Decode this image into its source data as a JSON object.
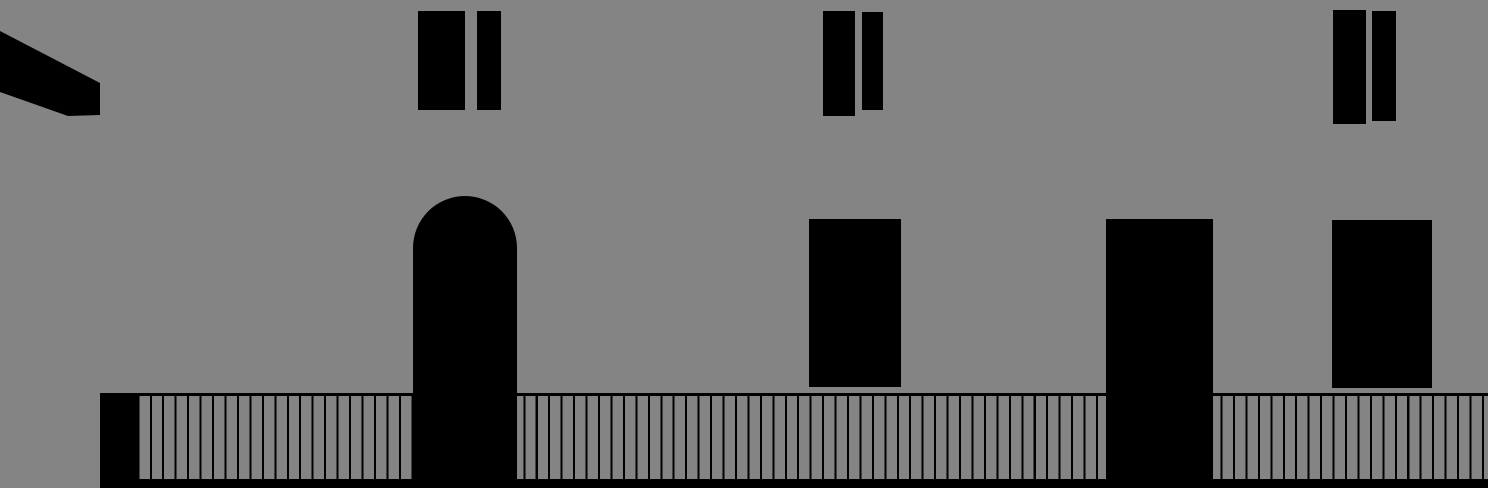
{
  "scene": {
    "colors": {
      "background": "#848484",
      "ink": "#000000",
      "slat": "#848484"
    },
    "stage": {
      "width": 1488,
      "height": 488
    },
    "elements": [
      {
        "type": "fence",
        "name": "boardwalk-fence",
        "x": 100,
        "y": 393,
        "w": 1388,
        "h": 86,
        "top_line": 3,
        "slat_line": 2,
        "slat_period": 12.45
      },
      {
        "type": "rect",
        "name": "ground-strip",
        "x": 100,
        "y": 479,
        "w": 1388,
        "h": 9
      },
      {
        "type": "rect",
        "name": "fence-end-post",
        "x": 100,
        "y": 393,
        "w": 39,
        "h": 95
      },
      {
        "type": "beam",
        "name": "roof-beam",
        "x": 0,
        "y": 0,
        "w": 102,
        "h": 120,
        "points": [
          [
            0,
            31
          ],
          [
            100,
            83
          ],
          [
            100,
            115
          ],
          [
            68,
            116
          ],
          [
            0,
            92
          ]
        ]
      },
      {
        "type": "rect",
        "name": "window-1-left",
        "x": 418,
        "y": 11,
        "w": 47,
        "h": 99
      },
      {
        "type": "rect",
        "name": "window-1-right",
        "x": 477,
        "y": 11,
        "w": 24,
        "h": 99
      },
      {
        "type": "rect",
        "name": "window-2-left",
        "x": 823,
        "y": 11,
        "w": 32,
        "h": 105
      },
      {
        "type": "rect",
        "name": "window-2-right",
        "x": 862,
        "y": 12,
        "w": 21,
        "h": 98
      },
      {
        "type": "rect",
        "name": "window-3-left",
        "x": 1333,
        "y": 10,
        "w": 33,
        "h": 114
      },
      {
        "type": "rect",
        "name": "window-3-right",
        "x": 1372,
        "y": 11,
        "w": 24,
        "h": 110
      },
      {
        "type": "arch",
        "name": "arched-doorway",
        "x": 413,
        "y": 196,
        "w": 104,
        "h": 292,
        "radius": 52
      },
      {
        "type": "rect",
        "name": "doorway-left",
        "x": 809,
        "y": 219,
        "w": 92,
        "h": 168
      },
      {
        "type": "rect",
        "name": "doorway-tall",
        "x": 1106,
        "y": 219,
        "w": 107,
        "h": 269
      },
      {
        "type": "rect",
        "name": "doorway-right",
        "x": 1332,
        "y": 220,
        "w": 100,
        "h": 168
      }
    ]
  }
}
